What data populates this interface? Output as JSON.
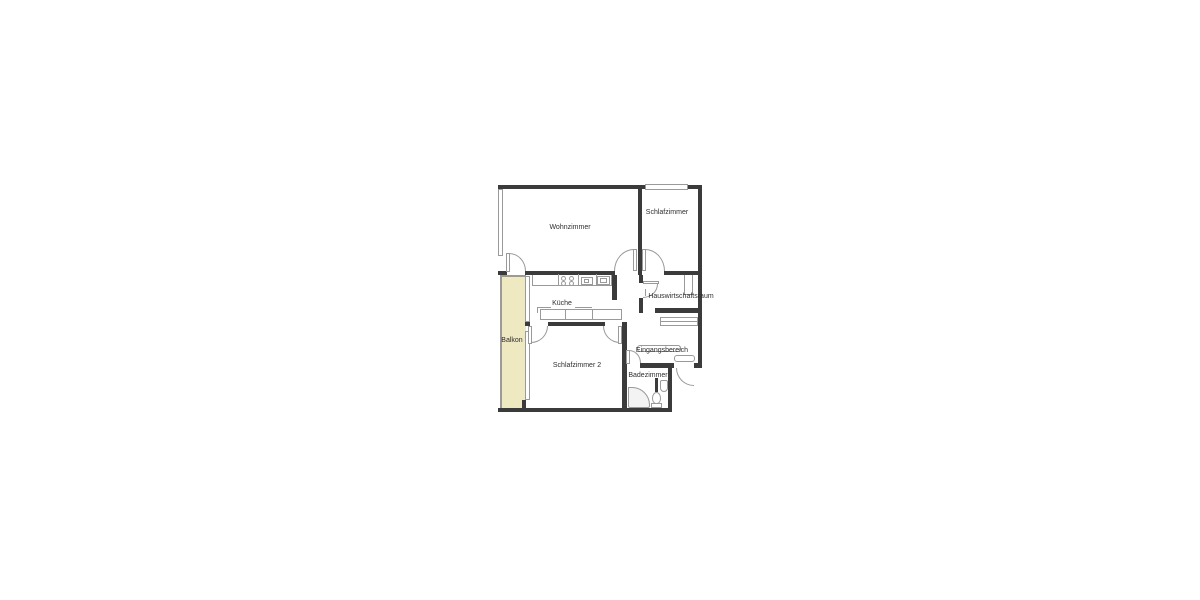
{
  "colors": {
    "wall": "#3b3b3b",
    "line": "#9a9a9a",
    "balcony": "#efe9c2",
    "ink": "#2e2e2e",
    "fixture": "#f3f3f3"
  },
  "rooms": {
    "living": {
      "label": "Wohnzimmer"
    },
    "bedroom1": {
      "label": "Schlafzimmer"
    },
    "kitchen": {
      "label": "Küche"
    },
    "utility": {
      "label": "Hauswirtschaftsraum"
    },
    "entrance": {
      "label": "Eingangsbereich"
    },
    "bathroom": {
      "label": "Badezimmer"
    },
    "balcony": {
      "label": "Balkon"
    },
    "bedroom2": {
      "label": "Schlafzimmer 2"
    }
  }
}
